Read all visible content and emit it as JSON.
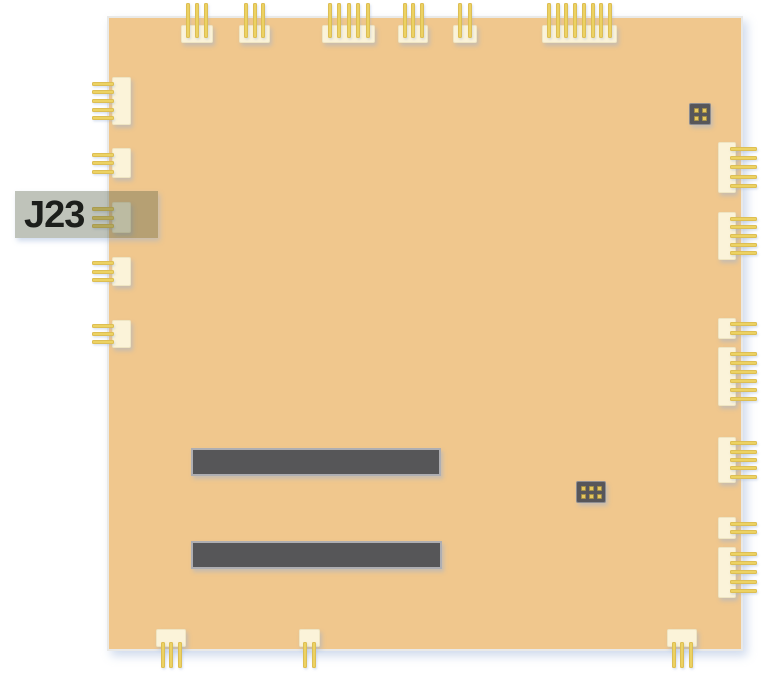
{
  "diagram": {
    "type": "pcb-connector-location-diagram",
    "highlighted_connector": "J23"
  },
  "colors": {
    "background": "#ffffff",
    "board": "#f0c78d",
    "board_edge": "#e9e9e7",
    "connector_body": "#fbf3d9",
    "connector_body_border": "#efe5c3",
    "pin": "#ecd263",
    "pin_edge": "rgba(200,160,60,0.4)",
    "slot": "#565658",
    "slot_border": "#aeaeb2",
    "chip": "#57565a",
    "chip_border": "#8d8d91",
    "chip_pad": "#e6c75f",
    "highlight": "rgba(88,98,74,0.38)",
    "label_text": "#1c1e1b",
    "shadow": "rgba(150,175,215,0.45)"
  },
  "board": {
    "x": 107,
    "y": 16,
    "width": 636,
    "height": 635
  },
  "label_box": {
    "text": "J23",
    "x": 15,
    "y": 191,
    "width": 143,
    "height": 47
  },
  "connectors": {
    "top": [
      {
        "x": 181,
        "w": 32,
        "pins": 3
      },
      {
        "x": 239,
        "w": 31,
        "pins": 3
      },
      {
        "x": 322,
        "w": 53,
        "pins": 5
      },
      {
        "x": 398,
        "w": 30,
        "pins": 3
      },
      {
        "x": 453,
        "w": 24,
        "pins": 2
      },
      {
        "x": 542,
        "w": 75,
        "pins": 8
      }
    ],
    "left": [
      {
        "y": 77,
        "h": 48,
        "pins": 5
      },
      {
        "y": 148,
        "h": 30,
        "pins": 3
      },
      {
        "y": 202,
        "h": 31,
        "pins": 3,
        "id": "J23"
      },
      {
        "y": 257,
        "h": 29,
        "pins": 3
      },
      {
        "y": 320,
        "h": 28,
        "pins": 3
      }
    ],
    "right": [
      {
        "y": 142,
        "h": 51,
        "pins": 5
      },
      {
        "y": 212,
        "h": 48,
        "pins": 5
      },
      {
        "y": 318,
        "h": 21,
        "pins": 2
      },
      {
        "y": 347,
        "h": 59,
        "pins": 6
      },
      {
        "y": 437,
        "h": 46,
        "pins": 5
      },
      {
        "y": 517,
        "h": 22,
        "pins": 2
      },
      {
        "y": 547,
        "h": 51,
        "pins": 5
      }
    ],
    "bottom": [
      {
        "x": 156,
        "w": 30,
        "pins": 3
      },
      {
        "x": 299,
        "w": 21,
        "pins": 2
      },
      {
        "x": 667,
        "w": 30,
        "pins": 3
      }
    ]
  },
  "memory_slots": [
    {
      "x": 191,
      "y": 448,
      "width": 250,
      "height": 28
    },
    {
      "x": 191,
      "y": 541,
      "width": 251,
      "height": 28
    }
  ],
  "chips": [
    {
      "x": 689,
      "y": 103,
      "width": 22,
      "height": 22,
      "pad_rows": 2,
      "pad_cols": 2
    },
    {
      "x": 576,
      "y": 481,
      "width": 30,
      "height": 22,
      "pad_rows": 2,
      "pad_cols": 3
    }
  ]
}
